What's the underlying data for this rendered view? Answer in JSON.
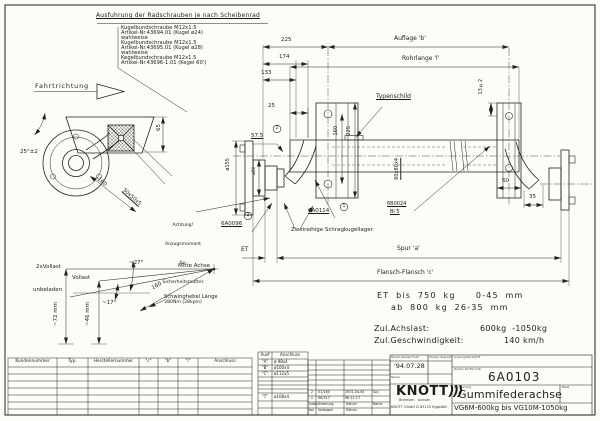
{
  "drawing": {
    "bolt_note": {
      "title": "Ausfuhrung der Radschrauben je nach Scheibenrad",
      "lines": [
        "Kugelbundschraube M12x1.5",
        "Artikel-Nr.43694.01 (Kugel ø24)",
        "wahlweise",
        "Kugelbundschraube M12x1.5",
        "Artikel-Nr.43695.01 (Kugel ø28)",
        "wahlweise",
        "Kegelbundschraube M12x1.5",
        "Artikel-Nr.43696-1.01 (Kegel 60')"
      ]
    },
    "direction_label": "Fahrtrichtung",
    "warning_note": {
      "l1": "Achtung!",
      "l2": "Anzugsmoment",
      "l3": "fur",
      "l4": "Sicherheitsmutter",
      "l5": "280Nm (28kpm)"
    },
    "labels": {
      "typenschild": "Typenschild",
      "auflage": "Auflage 'b'",
      "rohrlange": "Rohrlange 'l'",
      "spur": "Spur 'a'",
      "flansch": "Flansch-Flansch 'c'",
      "et": "ET",
      "bearing": "Zweireihige Schragkugellager",
      "part_arm": "6A0114",
      "part_arm_index": "1",
      "part_nut": "6A0096",
      "part_nut_index": "2",
      "part_bracket": "6B0024",
      "part_bracket_sheet": "Bl 5",
      "tube_section": "80x80x4",
      "arm_section": "50x50x5"
    },
    "dims": {
      "d225": "225",
      "d174": "174",
      "d133": "133",
      "d25": "25",
      "d57_5": "57.5",
      "d160v": "160",
      "d225v": "225",
      "d13": "13±2",
      "d60": "60",
      "d35": "35",
      "d65": "65",
      "d160_arm": "160",
      "angle": "25°±2",
      "dia155": "ø155",
      "dia56": "ø56"
    }
  },
  "load_diagram": {
    "full2": "2xVollast",
    "full": "Vollast",
    "empty": "unbeladen",
    "angle_top": "~27°",
    "angle_bottom": "~17°",
    "axis": "Mitte Achse",
    "radius": "160",
    "arm_label": "Schwinghebel Länge",
    "h72": "~72 mm",
    "h46": "~46 mm"
  },
  "specs": {
    "et_row1": "ET bis 750 kg   0-45 mm",
    "et_row2": "ab 800 kg 26-35 mm",
    "load_label": "Zul.Achslast:",
    "load_value": "600kg  -1050kg",
    "speed_label": "Zul.Geschwindigkeit:",
    "speed_value": "140 km/h"
  },
  "customer_table": {
    "headers": [
      "Kundennummer",
      "Typ.",
      "Herstellernummer",
      "\"c\"",
      "\"b\"",
      "\"l\"",
      "Anschluss"
    ]
  },
  "variant_table": {
    "col1": "Ausf",
    "col2": "Anschluss",
    "rows": [
      {
        "k": "\"A\"",
        "v": "ø 98x4"
      },
      {
        "k": "\"B\"",
        "v": "ø100x4"
      },
      {
        "k": "\"C\"",
        "v": "ø112x5"
      },
      {
        "k": "\"T\"",
        "v": "ø108x4"
      }
    ]
  },
  "revision_table": {
    "entries": [
      {
        "idx": "2",
        "no": "01/160",
        "date": "2001.04.04",
        "name": "Sa.J"
      },
      {
        "idx": "1",
        "no": "96/317",
        "date": "96.11.17",
        "name": ""
      }
    ],
    "footer": {
      "c1": "Index",
      "c2": "Änderung",
      "c3": "Datum",
      "c4": "Name",
      "c1b": "bei",
      "c2b": "Vollzogen",
      "c3b": "Datum"
    }
  },
  "title_block": {
    "drawn_label": "Bearb./Gezeichnet",
    "checked_label": "Überpr./Geprüft",
    "date": "'94.07.28",
    "name_label": "Name",
    "material_label": "Auszug/Werkstoff",
    "regno_label": "Zeichn-Nr/Fach-Nr",
    "drawing_no": "6A0103",
    "name_title_label": "Benennung",
    "title": "Gummifederachse",
    "sheet_label": "Blatt",
    "subtitle": "VG6M-600kg bis VG10M-1050kg",
    "company": "KNOTT",
    "company_arcs": ")))",
    "company_sub": "Bremsen   Achsen",
    "company_addr": "KNOTT GmbH D 83125 Eggstätt"
  }
}
